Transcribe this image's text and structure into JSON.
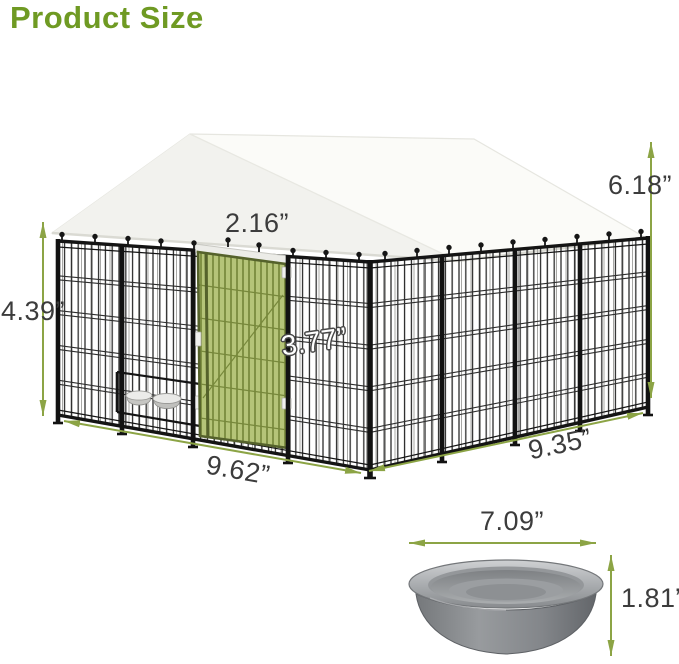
{
  "page": {
    "title": "Product Size"
  },
  "colors": {
    "title_green": "#6f9a23",
    "arrow_green": "#8ca445",
    "dim_text": "#3c3c3c",
    "door_green": "#b5c478",
    "door_bar_green": "#77883b",
    "door_frame_green": "#55622b",
    "canopy_white": "#fbfbf8",
    "canopy_shade": "#f2f2ee",
    "frame_black": "#141414",
    "bowl_steel": "#9b9ea1"
  },
  "kennel": {
    "description": "dog kennel with white canopy roof, black wire panels, green door and feeding bowls",
    "dims": {
      "canopy_height": "6.18”",
      "door_width": "2.16”",
      "panel_height": "4.39”",
      "inner_height": "3.77”",
      "front_width": "9.62”",
      "side_width": "9.35”"
    }
  },
  "bowl": {
    "description": "stainless steel pet bowl",
    "dims": {
      "diameter": "7.09”",
      "height": "1.81”"
    }
  }
}
